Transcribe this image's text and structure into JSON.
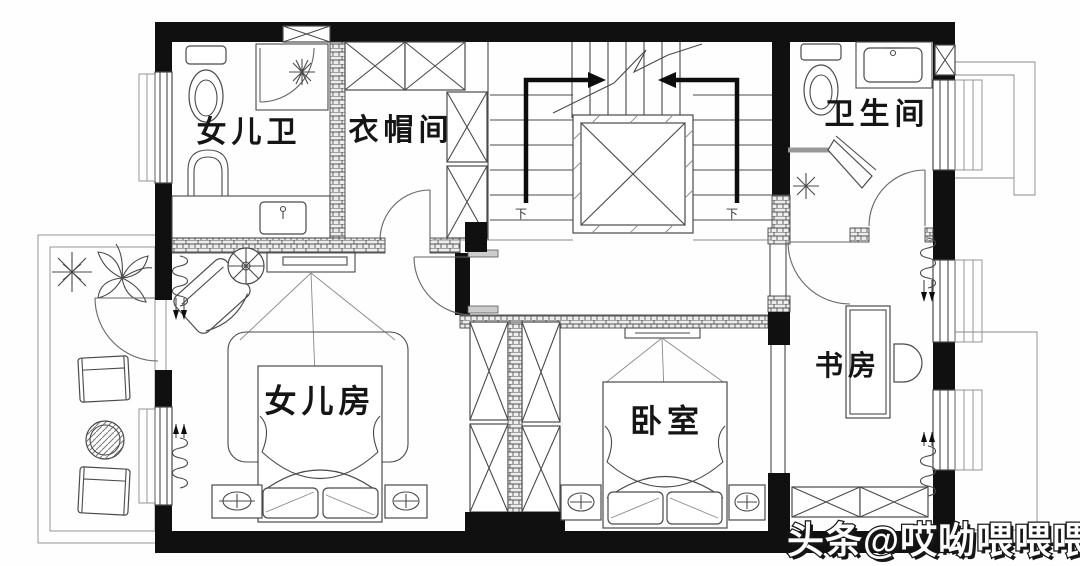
{
  "plan_title": "second-floor residential plan",
  "rooms": {
    "daughter_bath": {
      "label": "女儿卫"
    },
    "cloakroom": {
      "label": "衣帽间"
    },
    "bathroom": {
      "label": "卫生间"
    },
    "daughter_room": {
      "label": "女儿房"
    },
    "bedroom": {
      "label": "卧室"
    },
    "study": {
      "label": "书房"
    }
  },
  "stairs": {
    "left_down_label": "下",
    "right_down_label": "下"
  },
  "watermark": {
    "text": "头条@哎呦喂喂喂韦"
  },
  "colors": {
    "wall": "#101010",
    "line": "#4a4a4a",
    "background": "#fefefe",
    "watermark_fill": "#ffffff",
    "watermark_outline": "#161616"
  }
}
